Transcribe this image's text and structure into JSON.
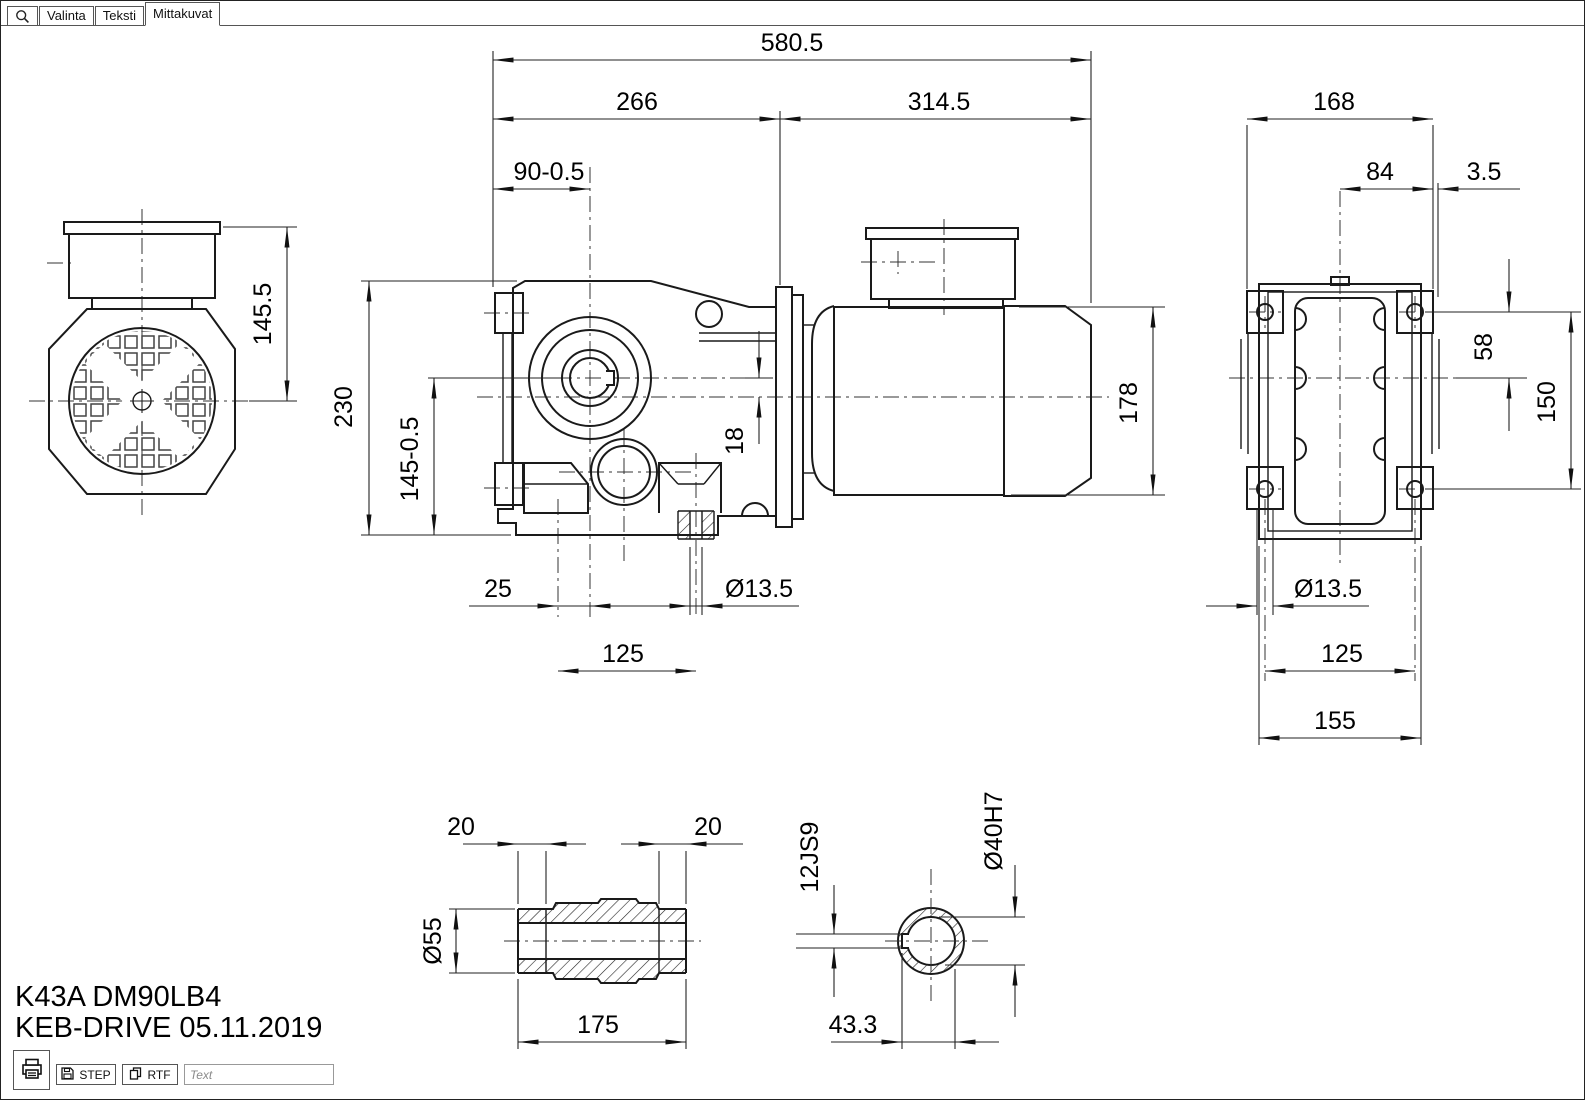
{
  "tabs": {
    "items": [
      {
        "label": "Valinta"
      },
      {
        "label": "Teksti"
      },
      {
        "label": "Mittakuvat"
      }
    ],
    "active": "Mittakuvat"
  },
  "icons": {
    "search": "magnifier-icon",
    "print": "printer-icon",
    "step": "floppy-disk-icon",
    "rtf": "copy-pages-icon"
  },
  "title": {
    "model": "K43A DM90LB4",
    "brand_date": "KEB-DRIVE 05.11.2019"
  },
  "toolbar": {
    "step": "STEP",
    "rtf": "RTF",
    "input_placeholder": "Text",
    "input_value": ""
  },
  "drawing": {
    "front": {
      "height_to_axis": "145.5"
    },
    "side": {
      "overall_length": "580.5",
      "gearbox_length": "266",
      "motor_length": "314.5",
      "face_to_axis": "90-0.5",
      "housing_height": "230",
      "axis_height": "145-0.5",
      "axis_offset": "18",
      "motor_height": "178",
      "foot_hole_to_axis": "25",
      "foot_hole_dia": "Ø13.5",
      "foot_hole_pitch": "125"
    },
    "bottom": {
      "overall_width": "168",
      "axis_to_edge": "84",
      "pad_height": "3.5",
      "axis_to_hole": "58",
      "hole_span": "150",
      "hole_dia": "Ø13.5",
      "hole_pitch": "125",
      "base_width": "155"
    },
    "shaft": {
      "groove_left": "20",
      "groove_right": "20",
      "outer_dia": "Ø55",
      "length": "175"
    },
    "bore": {
      "keyway_width": "12JS9",
      "bore_dia": "Ø40H7",
      "keyway_depth": "43.3"
    }
  }
}
